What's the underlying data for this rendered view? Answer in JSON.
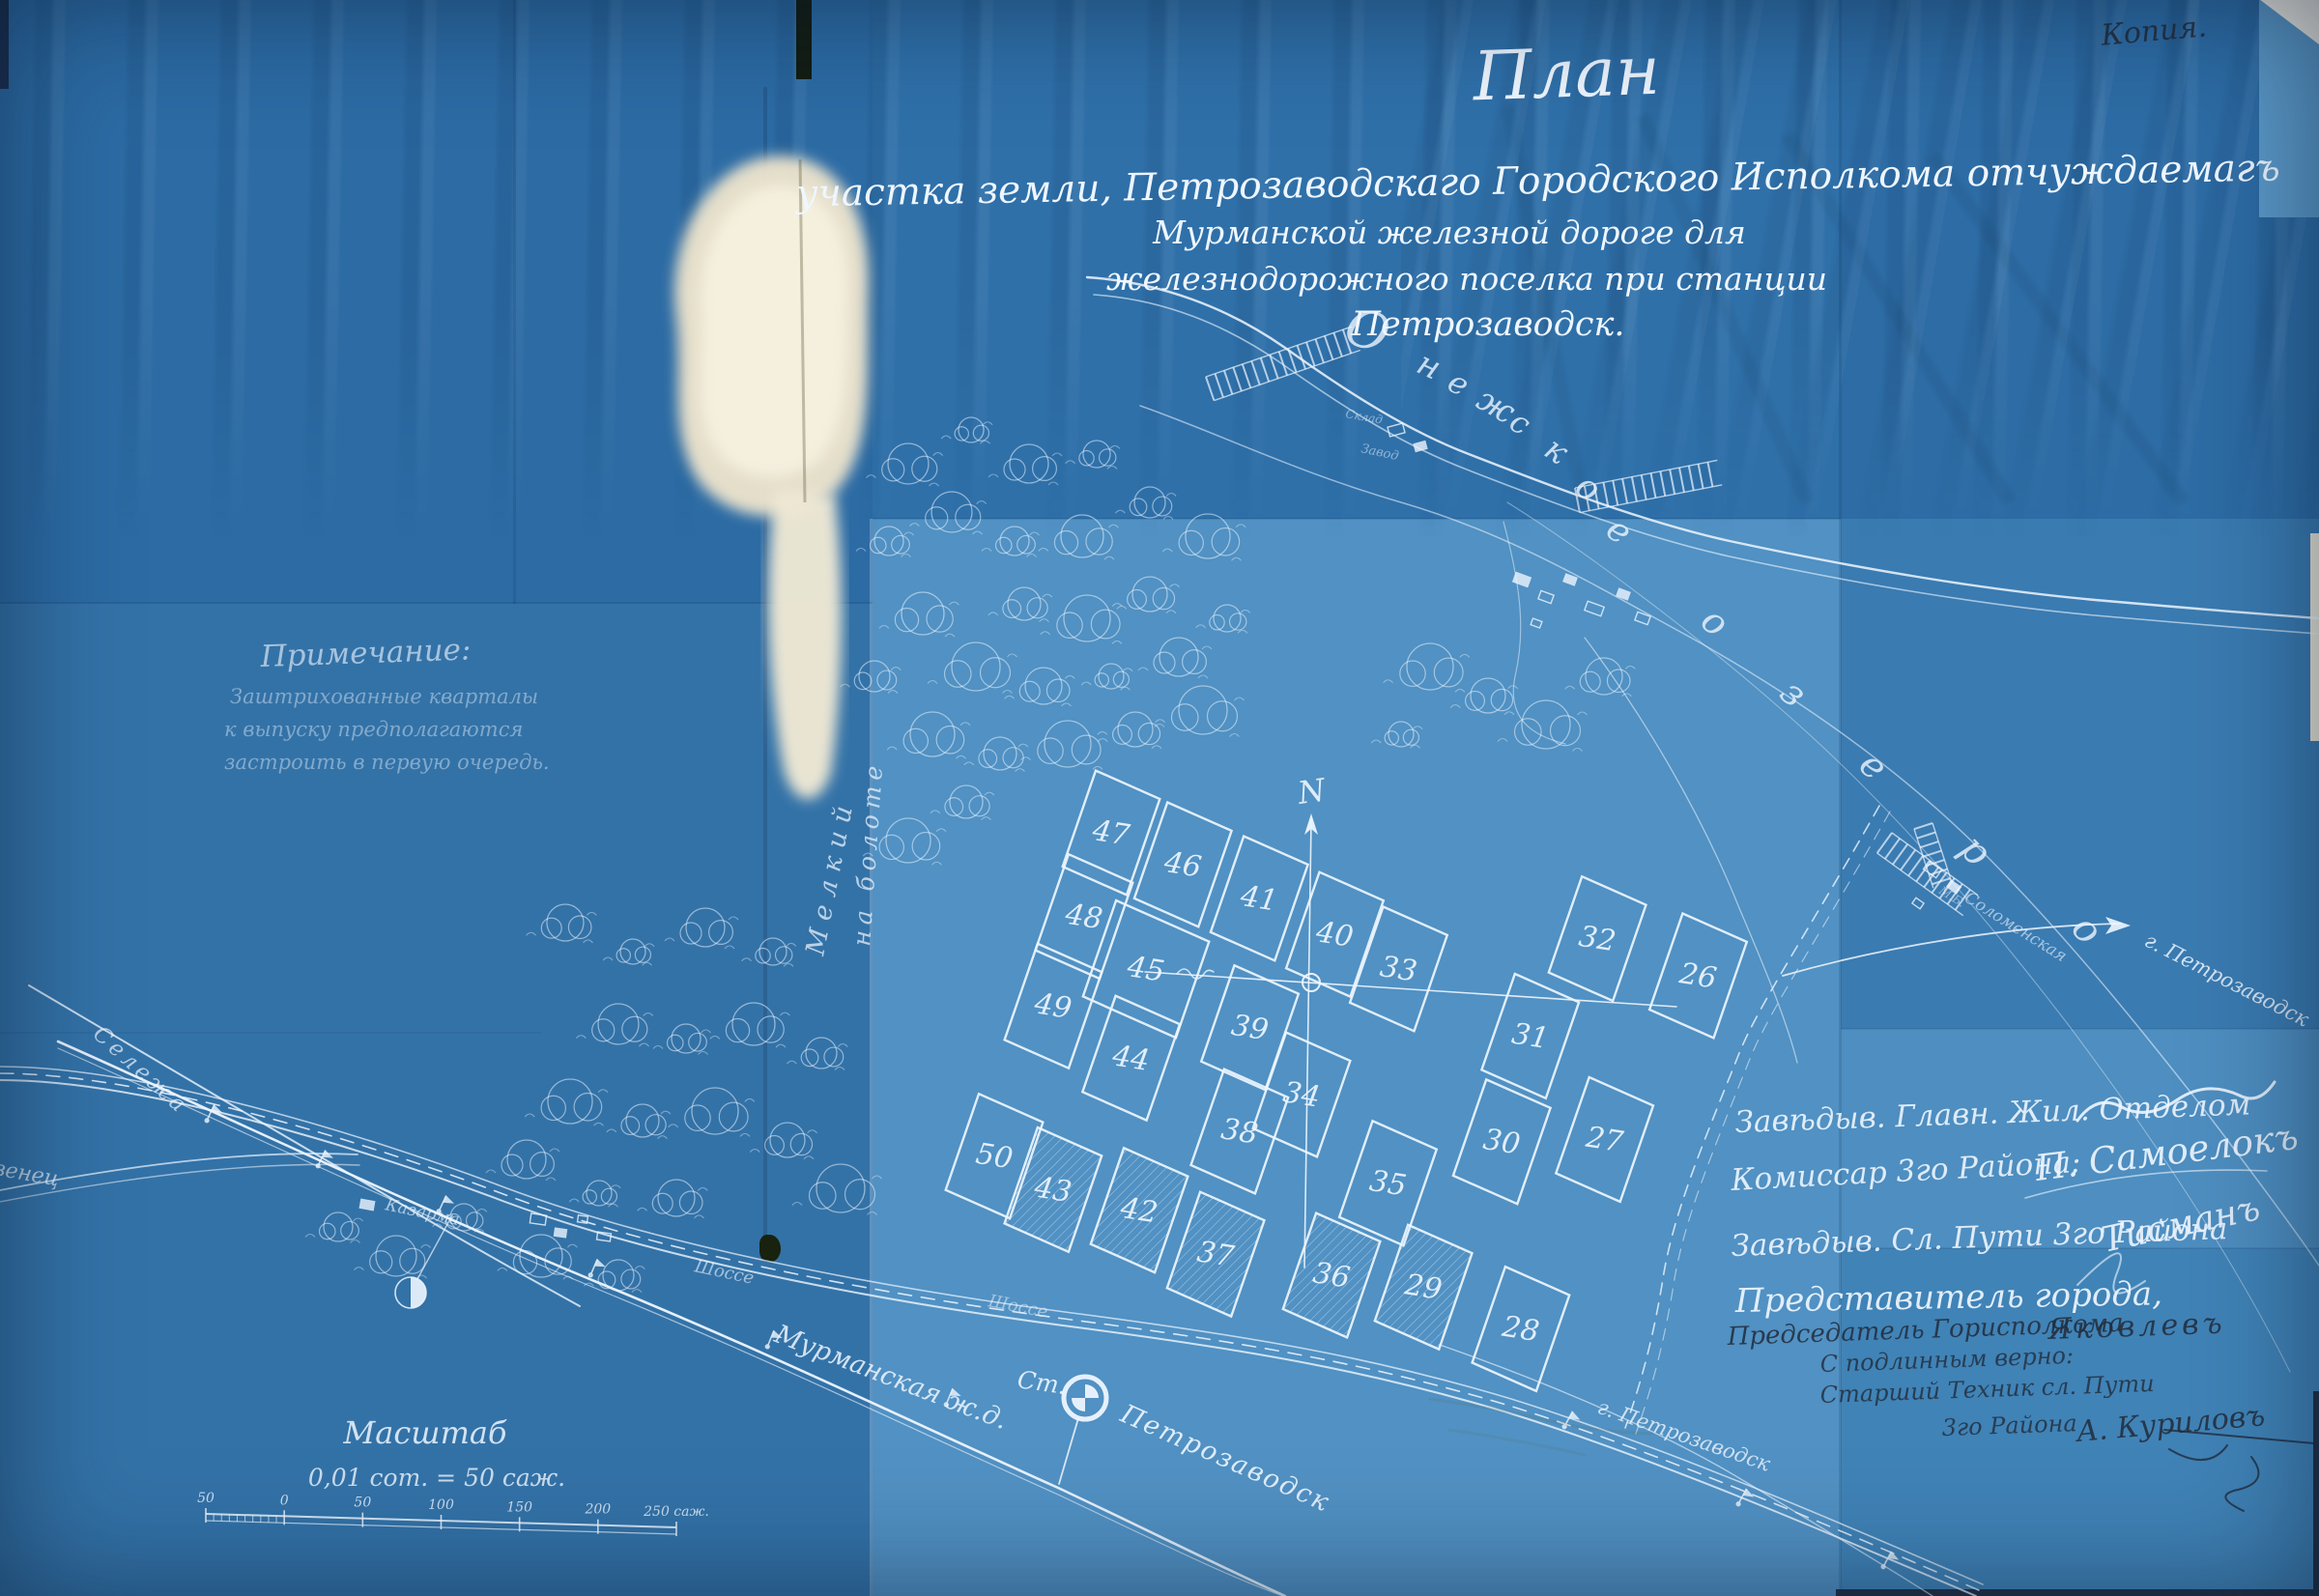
{
  "annotation": {
    "copy_mark": "Копия."
  },
  "title": {
    "main": "План",
    "line1": "участка земли, Петрозаводскаго Городского Исполкома отчуждаемагъ",
    "line2": "Мурманской железной дороге для",
    "line3": "железнодорожного поселка при станции",
    "line4": "Петрозаводск."
  },
  "note": {
    "heading": "Примечание:",
    "lines": [
      "Заштрихованные кварталы",
      "к выпуску предполагаются",
      "застроить в первую очередь."
    ]
  },
  "lake": {
    "word1": "Онежское",
    "word2": "озеро"
  },
  "labels": {
    "north": "N",
    "railway": "Мурманская ж.д.",
    "highway": "Шоссе",
    "street": "Шоссе",
    "river": "Сележа",
    "povenets": "Повенец",
    "barracks": "Казарма",
    "solomennoe": "Соломенская",
    "mb": "М.Б.",
    "warehouse": "Склад",
    "factory": "Завод",
    "station_prefix": "Ст.",
    "station_name": "Петрозаводск",
    "city_right": "г. Петрозаводск",
    "city_bottom": "г. Петрозаводск",
    "swamp1": "Мелкий",
    "swamp2": "на болоте"
  },
  "scale": {
    "heading": "Масштаб",
    "ratio": "0,01 сот. = 50 саж.",
    "ticks": [
      "50",
      "0",
      "50",
      "100",
      "150",
      "200",
      "250 саж."
    ]
  },
  "signatures": {
    "line1": "Завѣдыв. Главн. Жил. Отделом",
    "line2": "Комиссар 3го Района:",
    "line2_sig": "П. Самоелокъ",
    "line3": "Завѣдыв. Сл. Пути 3го Района",
    "line3_sig": "Тисманъ",
    "line4": "Представитель города,",
    "line5": "Председатель Горисполкома",
    "line5_sig": "Яковлевъ",
    "line6": "С подлинным верно:",
    "line7": "Старший Техник сл. Пути",
    "line8": "3го Района",
    "line8_sig": "А. Куриловъ"
  },
  "plots": [
    {
      "n": "47"
    },
    {
      "n": "46"
    },
    {
      "n": "41"
    },
    {
      "n": "40"
    },
    {
      "n": "33"
    },
    {
      "n": "32"
    },
    {
      "n": "26"
    },
    {
      "n": "48"
    },
    {
      "n": "45"
    },
    {
      "n": "39"
    },
    {
      "n": "34"
    },
    {
      "n": "31"
    },
    {
      "n": "30"
    },
    {
      "n": "27"
    },
    {
      "n": "49"
    },
    {
      "n": "44"
    },
    {
      "n": "38"
    },
    {
      "n": "35"
    },
    {
      "n": "50"
    },
    {
      "n": "43",
      "hatched": true
    },
    {
      "n": "42",
      "hatched": true
    },
    {
      "n": "37",
      "hatched": true
    },
    {
      "n": "36",
      "hatched": true
    },
    {
      "n": "29",
      "hatched": true
    },
    {
      "n": "28"
    }
  ],
  "colors": {
    "paper_blue": "#2f6fa6",
    "light_panel": "#5191c3",
    "line_white": "#eef6ff",
    "stain_cream": "#efe7d2",
    "ink_dark": "#222c3a"
  }
}
